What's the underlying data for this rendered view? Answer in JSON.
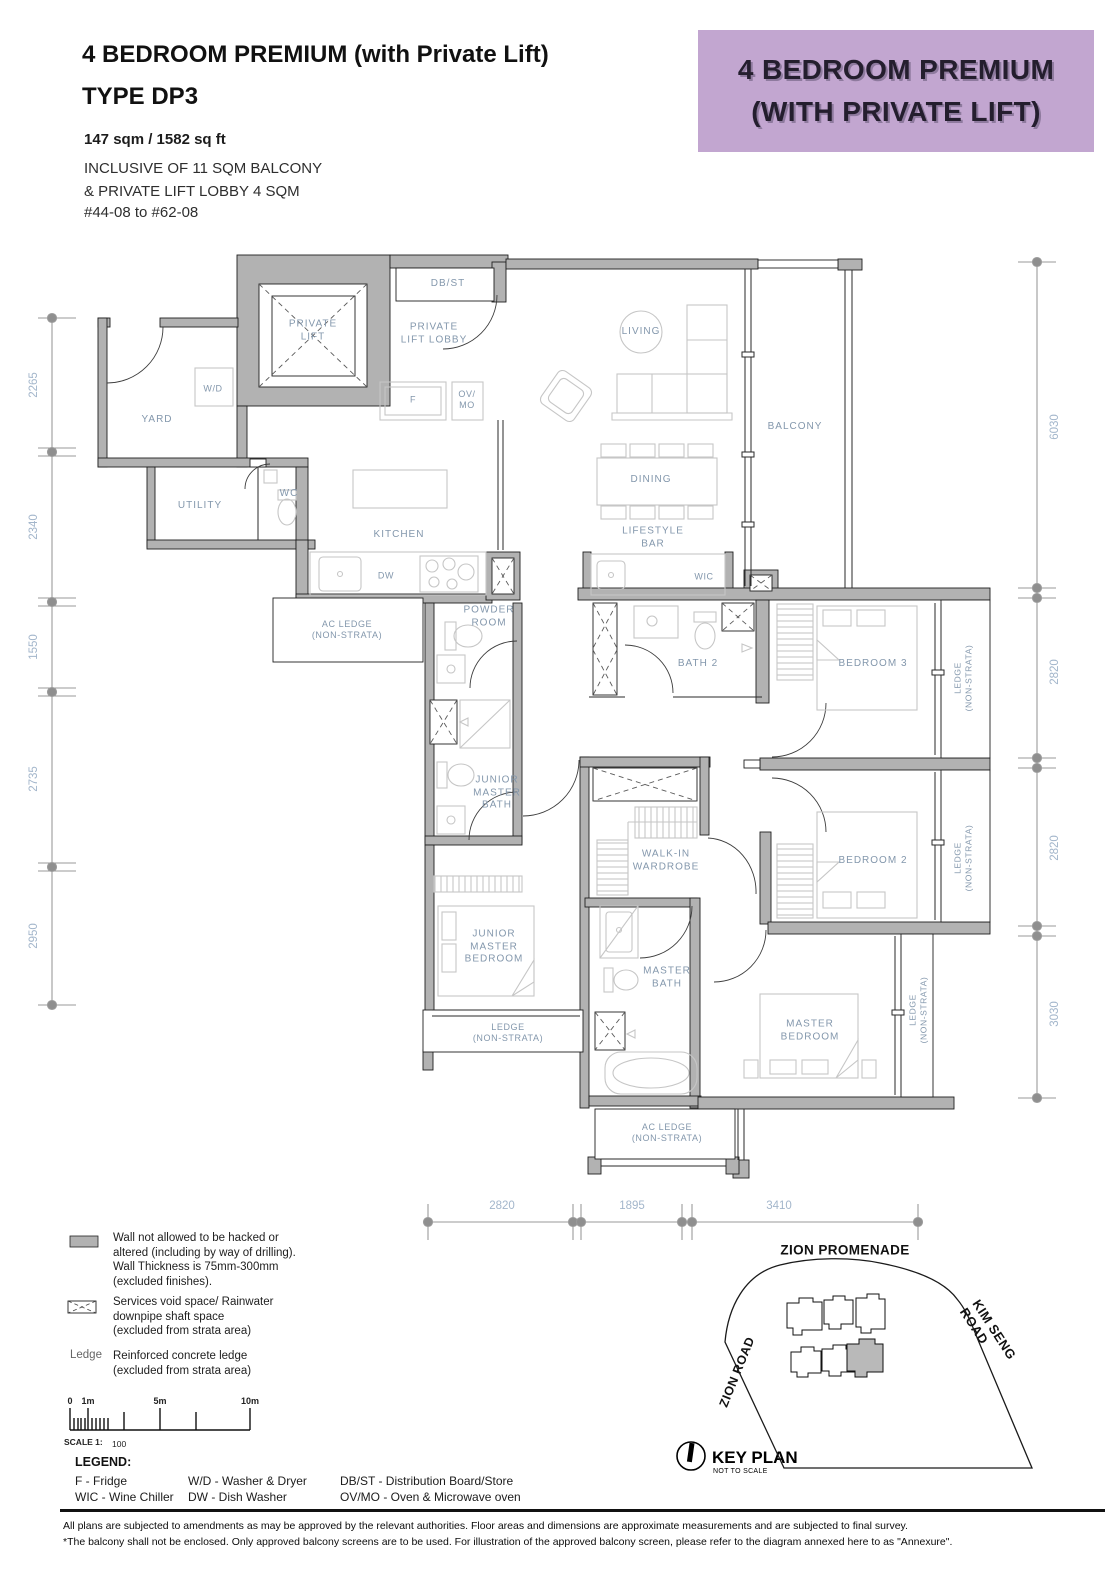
{
  "header": {
    "title": "4 BEDROOM PREMIUM (with Private Lift)\nTYPE DP3",
    "area": "147 sqm / 1582 sq ft",
    "inclusive": "INCLUSIVE OF 11 SQM BALCONY\n& PRIVATE LIFT LOBBY 4 SQM",
    "units": "#44-08 to #62-08",
    "banner": "4 BEDROOM PREMIUM\n(WITH PRIVATE LIFT)",
    "banner_bg": "#c2a6d0"
  },
  "plan": {
    "labels": [
      "DB/ST",
      "PRIVATE\nLIFT",
      "PRIVATE\nLIFT LOBBY",
      "W/D",
      "F",
      "OV/\nMO",
      "YARD",
      "LIVING",
      "BALCONY",
      "DINING",
      "UTILITY",
      "WC",
      "KITCHEN",
      "LIFESTYLE\nBAR",
      "DW",
      "WIC",
      "AC LEDGE\n(NON-STRATA)",
      "POWDER\nROOM",
      "BATH 2",
      "BEDROOM 3",
      "LEDGE\n(NON-STRATA)",
      "JUNIOR\nMASTER\nBATH",
      "WALK-IN\nWARDROBE",
      "BEDROOM 2",
      "LEDGE\n(NON-STRATA)",
      "JUNIOR\nMASTER\nBEDROOM",
      "MASTER\nBATH",
      "LEDGE\n(NON-STRATA)",
      "MASTER\nBEDROOM",
      "LEDGE\n(NON-STRATA)",
      "AC LEDGE\n(NON-STRATA)"
    ],
    "wall_color": "#b2b2b2",
    "label_color": "#8397ac"
  },
  "dims": {
    "left": [
      "2265",
      "2340",
      "1550",
      "2735",
      "2950"
    ],
    "right": [
      "6030",
      "2820",
      "2820",
      "3030"
    ],
    "bottom": [
      "2820",
      "1895",
      "3410"
    ]
  },
  "legend_symbols": {
    "wall": "Wall not allowed to be hacked or\naltered (including by way of drilling).\nWall Thickness is 75mm-300mm\n(excluded finishes).",
    "void": "Services void space/ Rainwater\ndownpipe shaft space\n(excluded from strata area)",
    "ledge_term": "Ledge",
    "ledge": "Reinforced concrete ledge\n(excluded from strata area)"
  },
  "scale": {
    "t0": "0",
    "t1": "1m",
    "t5": "5m",
    "t10": "10m",
    "label": "SCALE 1:",
    "value": "100"
  },
  "legend": {
    "title": "LEGEND:",
    "col1": "F - Fridge\nWIC - Wine Chiller",
    "col2": "W/D - Washer & Dryer\nDW - Dish Washer",
    "col3": "DB/ST  - Distribution Board/Store\nOV/MO - Oven & Microwave oven"
  },
  "key_plan": {
    "roads": [
      "ZION PROMENADE",
      "KIM SENG ROAD",
      "ZION ROAD"
    ],
    "blocks": [
      "01",
      "03",
      "06",
      "12",
      "10",
      "08"
    ],
    "highlighted_block": "08",
    "title": "KEY PLAN",
    "subtitle": "NOT TO SCALE"
  },
  "footer": {
    "line1": "All plans are subjected to amendments as may be approved by the relevant authorities. Floor areas and dimensions are approximate measurements and are subjected to final survey.",
    "line2": "*The balcony shall not be enclosed. Only approved balcony screens are to be used. For illustration of the approved balcony screen, please refer to the diagram annexed here to as \"Annexure\"."
  }
}
